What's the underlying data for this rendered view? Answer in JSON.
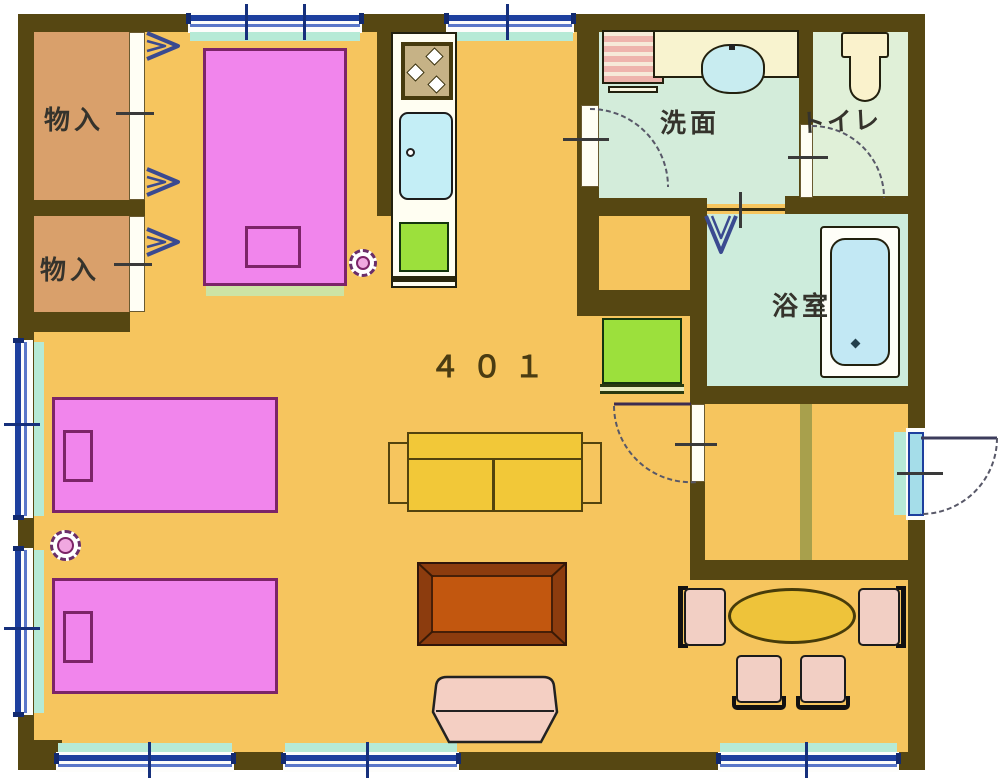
{
  "unit": {
    "number": "４０１"
  },
  "rooms": {
    "storage_1": {
      "label": "物入"
    },
    "storage_2": {
      "label": "物入"
    },
    "washroom": {
      "label": "洗面"
    },
    "toilet": {
      "label": "トイレ"
    },
    "bathroom": {
      "label": "浴室"
    }
  },
  "colors": {
    "wall": "#564712",
    "floor": "#f6c55e",
    "storage_floor": "#d9a06b",
    "washroom_floor": "#d3ecda",
    "toilet_floor": "#e0f0d8",
    "bathroom_floor": "#cdecdc",
    "bed_pink": "#f185ec",
    "bed_outline": "#7c2468",
    "window_navy": "#1d3f9e",
    "glass_cyan": "#b6ead6",
    "door_leaf_cyan": "#a5dde9",
    "fixture_green": "#9ce03c",
    "sofa_yellow": "#f2c838",
    "table_brown": "#8c3c0e",
    "table_inner": "#c2570f",
    "chair_pink": "#f2cfc4",
    "dining_table_yellow": "#eec33a",
    "tub_blue": "#c2e8f4",
    "sink_blue": "#c4eef6",
    "genkan_step": "#a8a04c"
  }
}
